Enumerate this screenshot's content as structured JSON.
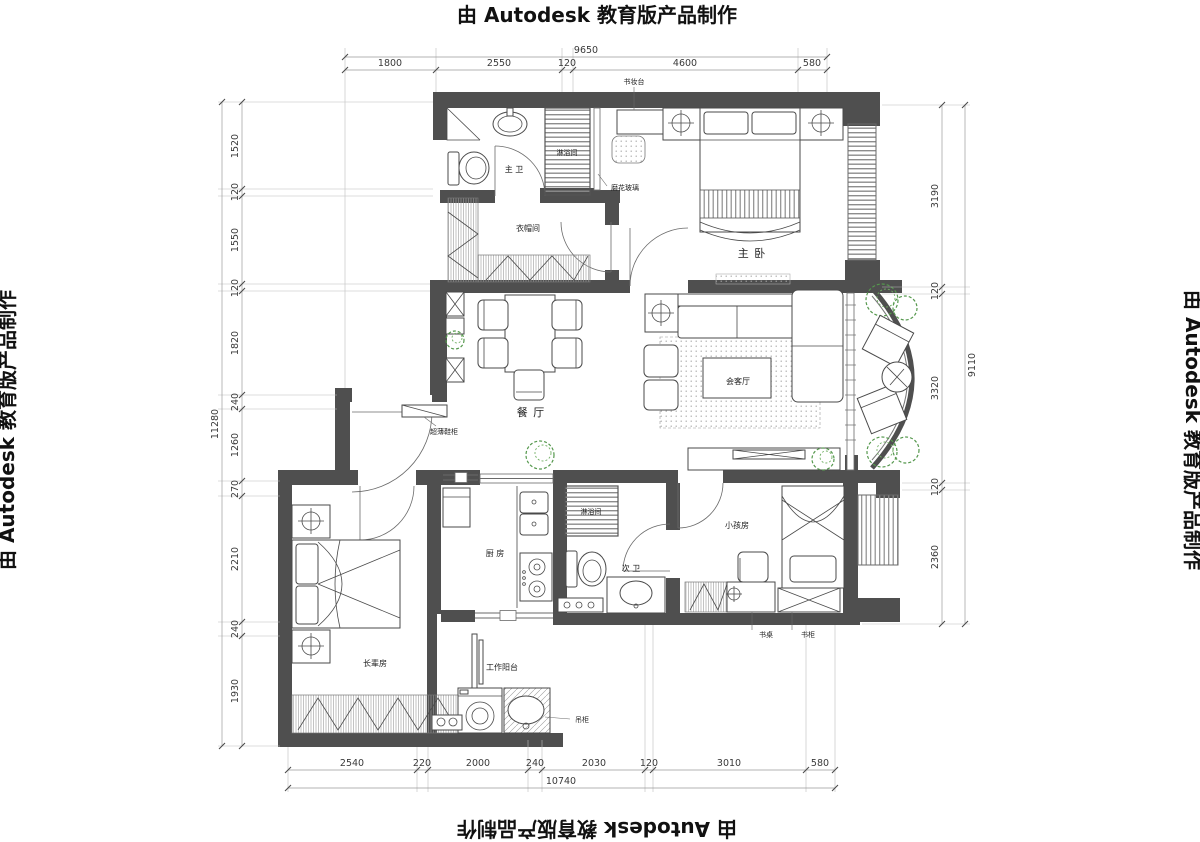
{
  "watermark": {
    "top": "由 Autodesk 教育版产品制作",
    "left": "由 Autodesk 教育版产品制作",
    "right": "由 Autodesk 教育版产品制作",
    "bottom": "由 Autodesk 教育版产品制作"
  },
  "rooms": {
    "master_bath": "主 卫",
    "shower_master": "淋浴间",
    "frosted_glass": "磨花玻璃",
    "dresser_desk": "书妆台",
    "closet": "衣帽间",
    "master_bedroom": "主 卧",
    "dining": "餐 厅",
    "shoe_cabinet": "超薄鞋柜",
    "living": "会客厅",
    "kitchen": "厨 房",
    "shower_second": "淋浴间",
    "second_bath": "次 卫",
    "kids_room": "小孩房",
    "desk": "书桌",
    "bookcase": "书柜",
    "elder_room": "长辈房",
    "work_balcony": "工作阳台",
    "hanging_cabinet": "吊柜"
  },
  "dims": {
    "top": {
      "total": "9650",
      "segments": [
        "1800",
        "2550",
        "120",
        "4600",
        "580"
      ]
    },
    "left": {
      "total": "11280",
      "segments": [
        "1520",
        "120",
        "1550",
        "120",
        "1820",
        "240",
        "1260",
        "270",
        "2210",
        "240",
        "1930"
      ]
    },
    "right": {
      "total": "9110",
      "segments": [
        "3190",
        "120",
        "3320",
        "120",
        "2360"
      ]
    },
    "bottom": {
      "total": "10740",
      "segments": [
        "2540",
        "220",
        "2000",
        "240",
        "2030",
        "120",
        "3010",
        "580"
      ]
    }
  }
}
